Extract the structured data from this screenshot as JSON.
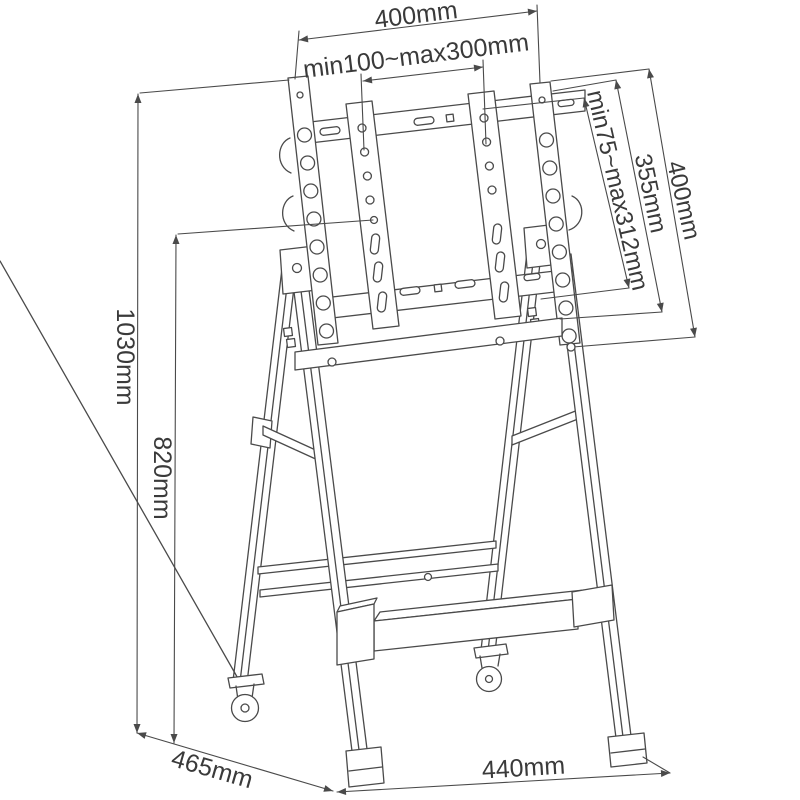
{
  "diagram": {
    "background_color": "#ffffff",
    "line_color": "#4a4a4a",
    "text_color": "#3a3a3a",
    "unit": "mm",
    "dimensions": {
      "top_width": "400mm",
      "mount_width_range": "min100~max300mm",
      "mount_height_range": "min75~max312mm",
      "bar_spacing": "355mm",
      "rail_length": "400mm",
      "total_height": "1030mm",
      "frame_height": "820mm",
      "base_depth": "465mm",
      "base_width": "440mm"
    }
  }
}
